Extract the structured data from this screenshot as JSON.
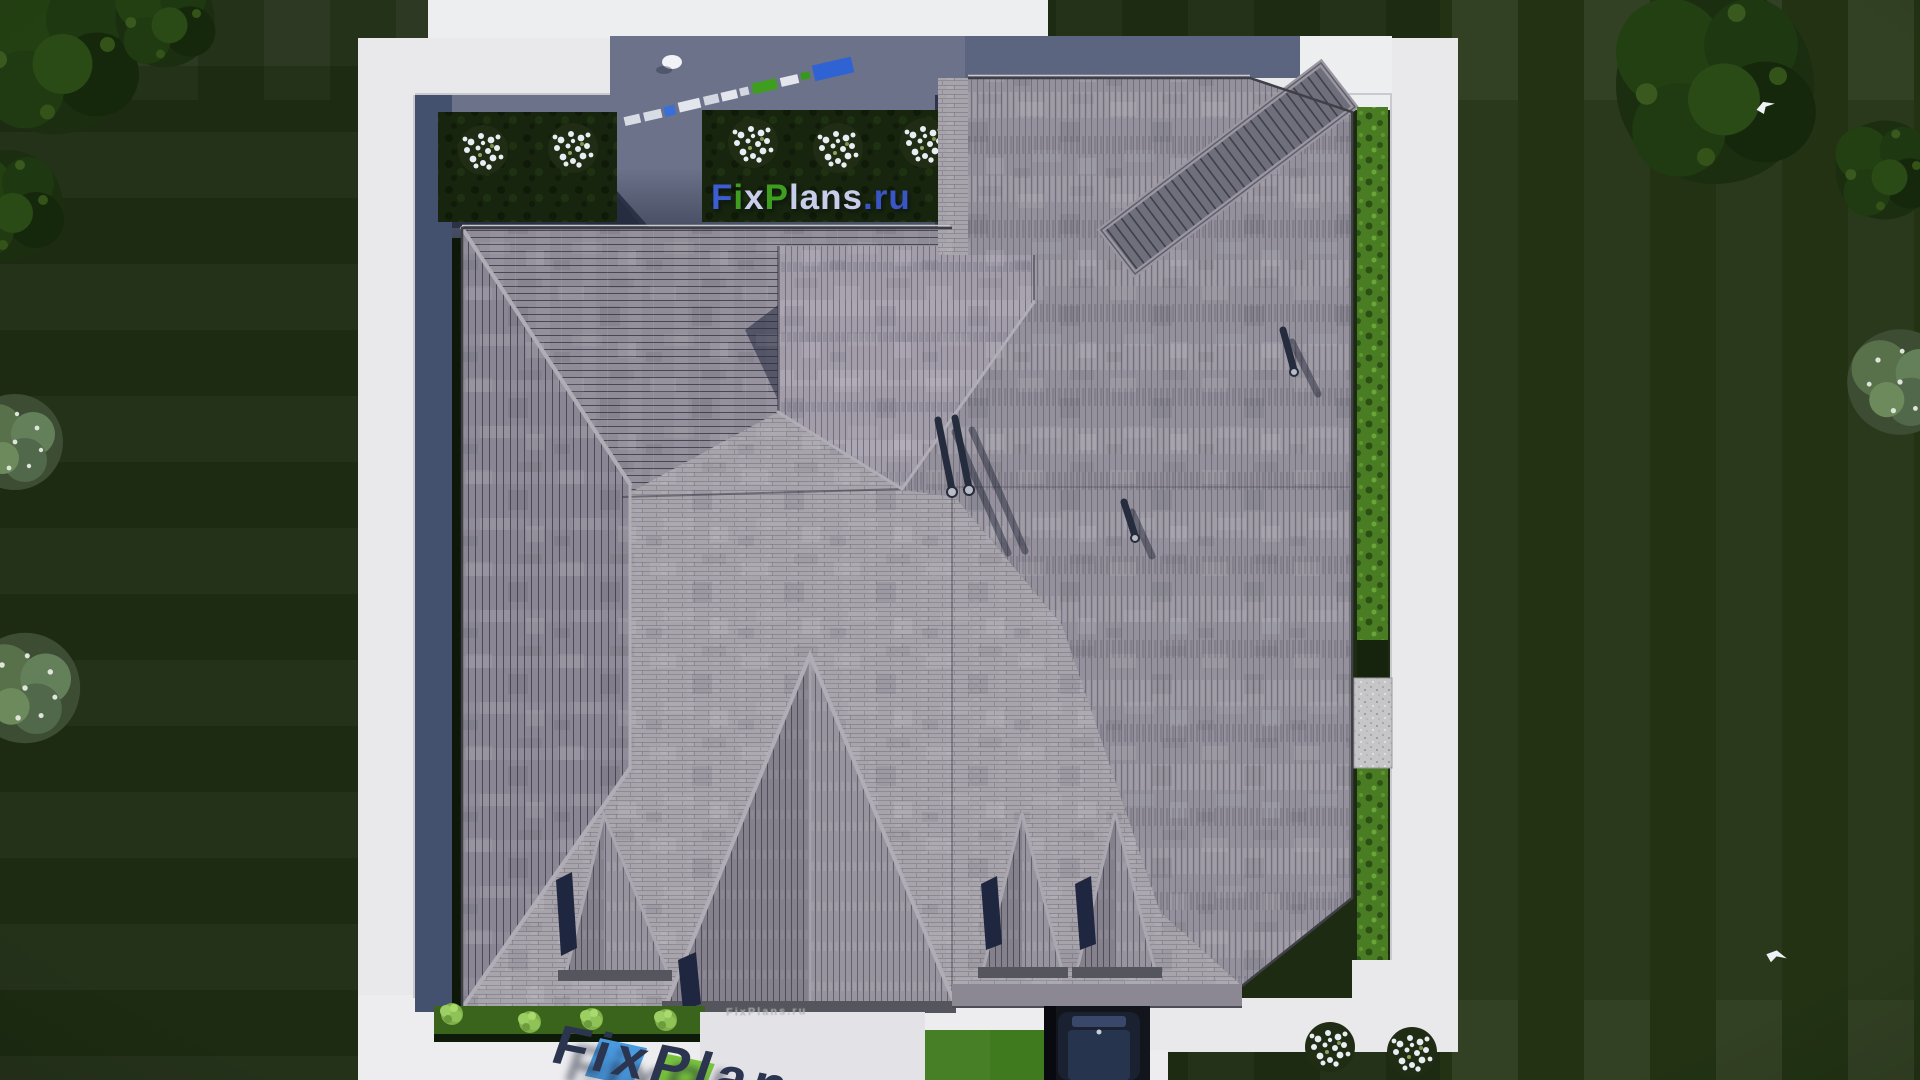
{
  "watermarks": {
    "center": {
      "text": "FixPlans.ru",
      "parts": [
        {
          "text": "F",
          "color": "#3c5ed2"
        },
        {
          "text": "i",
          "color": "#3f9d1f"
        },
        {
          "text": "x",
          "color": "#c9cdea"
        },
        {
          "text": "P",
          "color": "#3f9d1f"
        },
        {
          "text": "lans",
          "color": "#c9cdea"
        },
        {
          "text": ".ru",
          "color": "#3a55c6"
        }
      ]
    },
    "bottom_driveway": {
      "text": "FixPlans",
      "color": "#2c3550"
    },
    "embossed_porch": {
      "text": "FixPlans.ru"
    }
  },
  "palette": {
    "lawn": "#1d2b12",
    "bright_lawn": "#3f7a1e",
    "hedge_green": "#4a7d23",
    "bed_dark_green": "#17250e",
    "path_white": "#e9e9ec",
    "terrace_slate": "#6b7289",
    "walkway_slate": "#44516e",
    "shadow_navy": "#2b3245",
    "roof_light_field": "#a8a4ac",
    "roof_shingle_medium": "#8f8b97",
    "roof_diag_band": "#6f6f7b",
    "roof_eave": "#55555e",
    "ridge_cap": "#b0adb6",
    "car_navy": "#1b2334",
    "wm_blue": "#3c5ed2",
    "wm_green": "#3f9d1f",
    "wm_light": "#c9cdea",
    "wm_bottom_navy": "#2c3550",
    "wm_bottom_blue": "#4a9ae0",
    "wm_bottom_green": "#79c43f"
  }
}
